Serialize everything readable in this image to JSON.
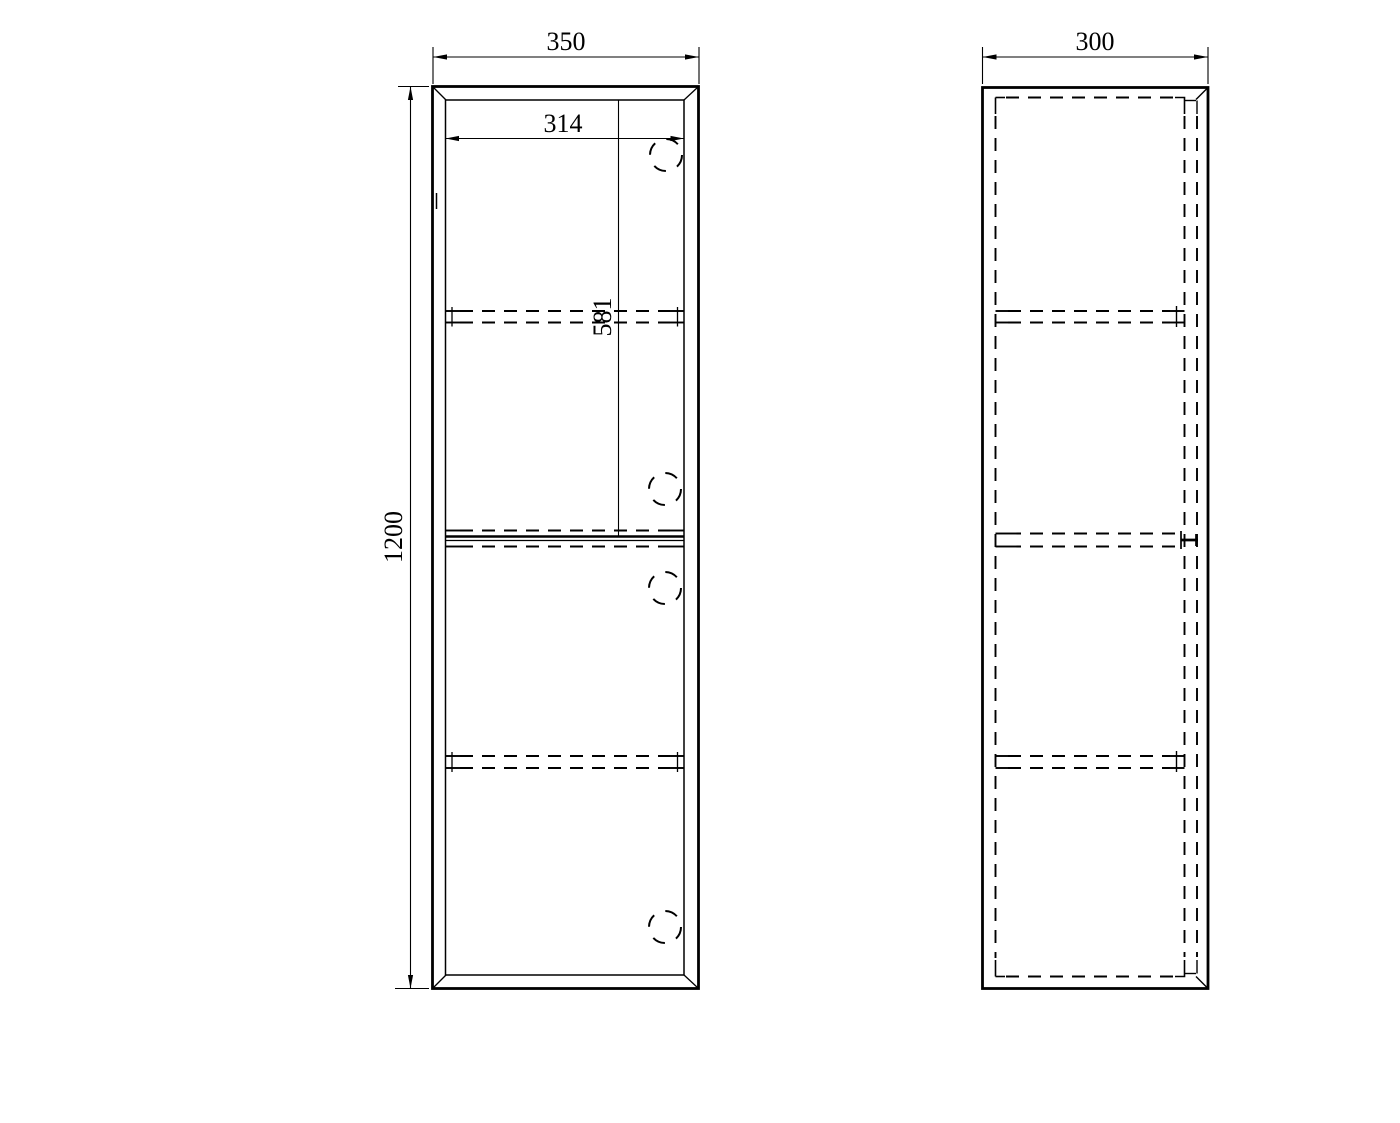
{
  "page": {
    "background_color": "#ffffff",
    "line_color": "#000000",
    "description_labels": {
      "drawing_type": "cabinet technical drawing"
    }
  },
  "drawing": {
    "front_view": {
      "width_label": "350",
      "height_label": "1200",
      "inner_width_label": "314",
      "upper_door_height_label": "581"
    },
    "side_view": {
      "depth_label": "300"
    }
  }
}
